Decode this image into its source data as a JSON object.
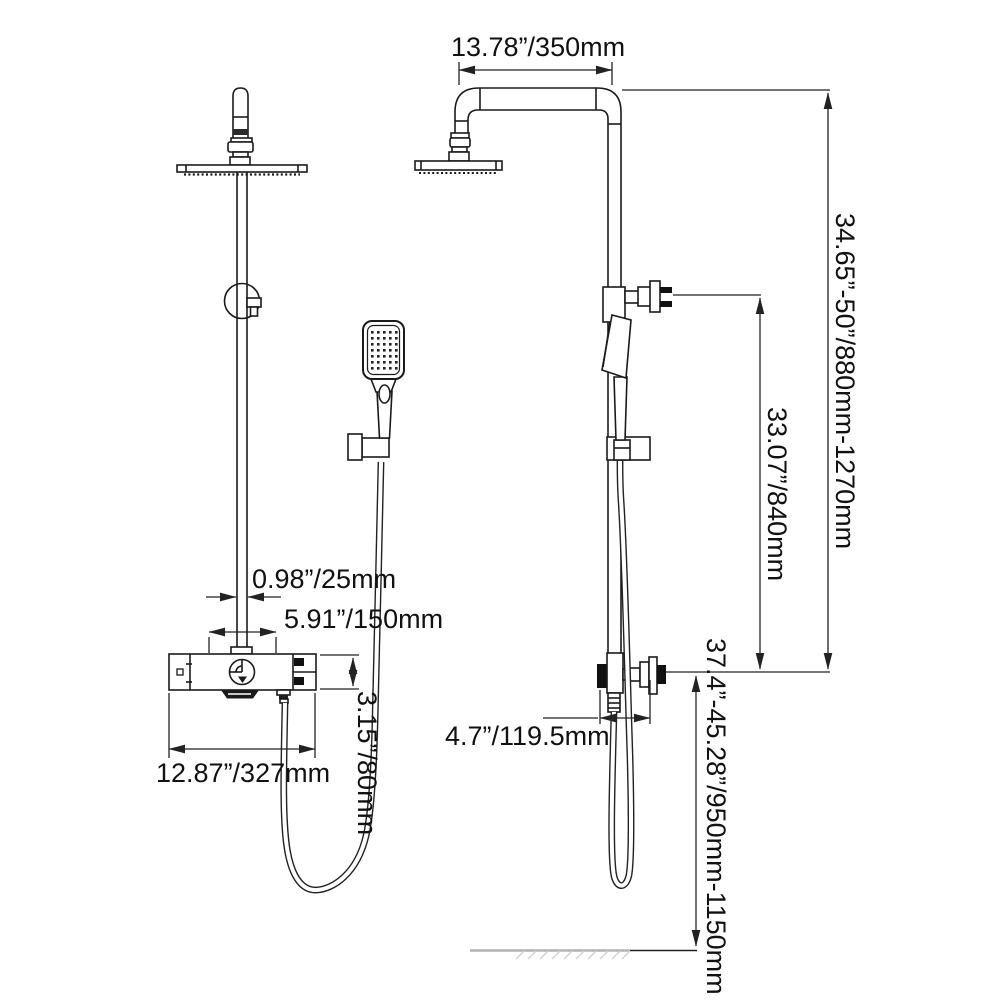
{
  "drawing": {
    "type": "technical-dimension-diagram",
    "subject": "exposed shower system with rain head, hand shower and thermostatic valve",
    "views": 2,
    "colors": {
      "line": "#1a1a1a",
      "dimension_line": "#222222",
      "ground": "#b3b3b3",
      "background": "#ffffff"
    },
    "labels": {
      "arm_reach": "13.78”/350mm",
      "overall_height": "34.65”-50”/880mm-1270mm",
      "upper_section_height": "33.07”/840mm",
      "valve_height_from_floor": "37.4”-45.28”/950mm-1150mm",
      "pipe_diameter": "0.98”/25mm",
      "inlet_spacing": "5.91”/150mm",
      "valve_body_height": "3.15”/80mm",
      "valve_body_width": "12.87”/327mm",
      "valve_depth": "4.7”/119.5mm"
    }
  }
}
